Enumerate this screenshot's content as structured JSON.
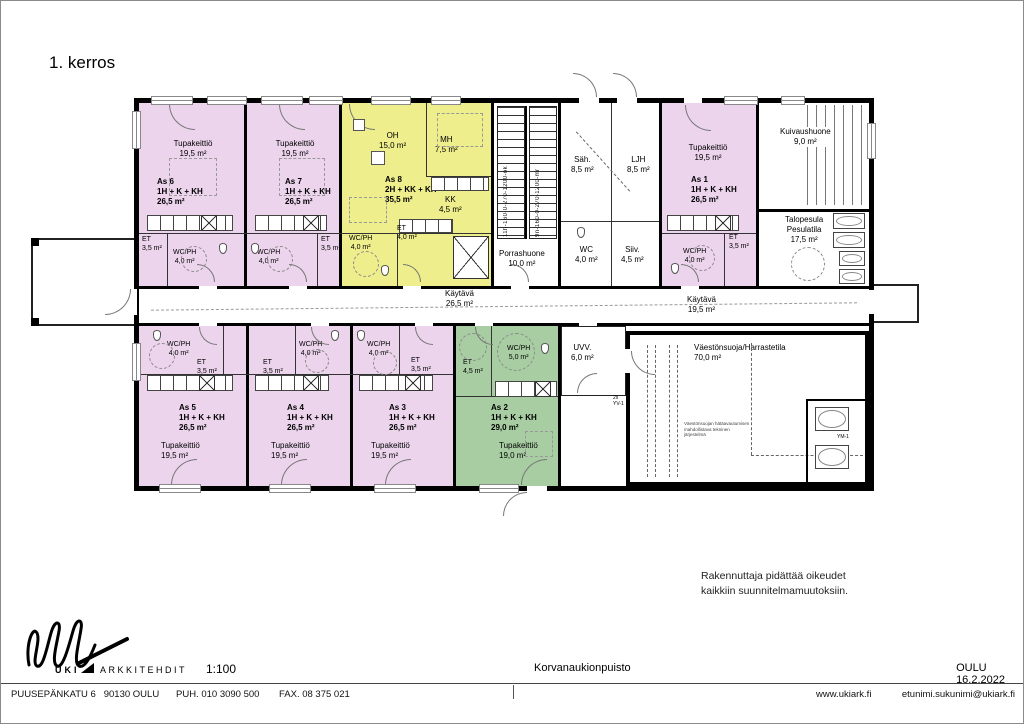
{
  "page": {
    "floor_title": "1. kerros",
    "disclaimer1": "Rakennuttaja pidättää oikeudet",
    "disclaimer2": "kaikkiin suunnitelmamuutoksiin."
  },
  "plan": {
    "apartments": {
      "as6": {
        "id": "As 6",
        "layout": "1H + K + KH",
        "area": "26,5 m²",
        "kitchen": "Tupakeittiö",
        "kitchen_area": "19,5 m²",
        "et": "ET",
        "et_area": "3,5 m²",
        "wc": "WC/PH",
        "wc_area": "4,0 m²"
      },
      "as7": {
        "id": "As 7",
        "layout": "1H + K + KH",
        "area": "26,5 m²",
        "kitchen": "Tupakeittiö",
        "kitchen_area": "19,5 m²",
        "et": "ET",
        "et_area": "3,5 m²",
        "wc": "WC/PH",
        "wc_area": "4,0 m²"
      },
      "as8": {
        "id": "As 8",
        "layout": "2H + KK + KH",
        "area": "35,5 m²",
        "oh": "OH",
        "oh_area": "15,0 m²",
        "mh": "MH",
        "mh_area": "7,5 m²",
        "kk": "KK",
        "kk_area": "4,5 m²",
        "et": "ET",
        "et_area": "4,0 m²",
        "wc": "WC/PH",
        "wc_area": "4,0 m²"
      },
      "as1": {
        "id": "As 1",
        "layout": "1H + K + KH",
        "area": "26,5 m²",
        "kitchen": "Tupakeittiö",
        "kitchen_area": "19,5 m²",
        "et": "ET",
        "et_area": "3,5 m²",
        "wc": "WC/PH",
        "wc_area": "4,0 m²"
      },
      "as5": {
        "id": "As 5",
        "layout": "1H + K + KH",
        "area": "26,5 m²",
        "kitchen": "Tupakeittiö",
        "kitchen_area": "19,5 m²",
        "et": "ET",
        "et_area": "3,5 m²",
        "wc": "WC/PH",
        "wc_area": "4,0 m²"
      },
      "as4": {
        "id": "As 4",
        "layout": "1H + K + KH",
        "area": "26,5 m²",
        "kitchen": "Tupakeittiö",
        "kitchen_area": "19,5 m²",
        "et": "ET",
        "et_area": "3,5 m²",
        "wc": "WC/PH",
        "wc_area": "4,0 m²"
      },
      "as3": {
        "id": "As 3",
        "layout": "1H + K + KH",
        "area": "26,5 m²",
        "kitchen": "Tupakeittiö",
        "kitchen_area": "19,5 m²",
        "et": "ET",
        "et_area": "3,5 m²",
        "wc": "WC/PH",
        "wc_area": "4,0 m²"
      },
      "as2": {
        "id": "As 2",
        "layout": "1H + K + KH",
        "area": "29,0 m²",
        "kitchen": "Tupakeittiö",
        "kitchen_area": "19,0 m²",
        "et": "ET",
        "et_area": "4,5 m²",
        "wc": "WC/PH",
        "wc_area": "5,0 m²"
      }
    },
    "rooms": {
      "porrashuone": {
        "name": "Porrashuone",
        "area": "10,0 m²"
      },
      "sah": {
        "name": "Säh.",
        "area": "8,5 m²"
      },
      "ljh": {
        "name": "LJH",
        "area": "8,5 m²"
      },
      "wc": {
        "name": "WC",
        "area": "4,0 m²"
      },
      "siiv": {
        "name": "Siiv.",
        "area": "4,5 m²"
      },
      "kuivaushuone": {
        "name": "Kuivaushuone",
        "area": "9,0 m²"
      },
      "talopesula": {
        "name1": "Talopesula",
        "name2": "Pesulatila",
        "area": "17,5 m²"
      },
      "kaytava_left": {
        "name": "Käytävä",
        "area": "26,5 m²"
      },
      "kaytava_right": {
        "name": "Käytävä",
        "area": "19,5 m²"
      },
      "uvv": {
        "name": "UVV.",
        "area": "6,0 m²"
      },
      "shelter": {
        "name": "Väestönsuoja/Harrastetila",
        "area": "70,0 m²"
      },
      "ym1": "YM-1"
    },
    "stairs": {
      "left_code": "11h-160-0-270-1200-ok",
      "right_code": "9n-160-0-270-1200-mr"
    },
    "notes": {
      "door_code1": "2x",
      "door_code2": "YV-1",
      "shelter_note1": "Väestönsuojan hätäavautumisen",
      "shelter_note2": "mahdollistava tekninen",
      "shelter_note3": "järjestelmä"
    }
  },
  "titleblock": {
    "logo_text": "UKI",
    "logo_text2": "ARKKITEHDIT",
    "scale": "1:100",
    "project": "Korvanaukionpuisto",
    "city_date": "OULU 16.2.2022",
    "address": "PUUSEPÄNKATU 6   90130 OULU",
    "phone": "PUH. 010 3090 500",
    "fax": "FAX. 08 375 021",
    "web": "www.ukiark.fi",
    "email": "etunimi.sukunimi@ukiark.fi"
  },
  "colors": {
    "apartment_pink": "#ecd4ec",
    "apartment_yellow": "#eeee8c",
    "apartment_green": "#a8cda2",
    "wall": "#000000"
  }
}
